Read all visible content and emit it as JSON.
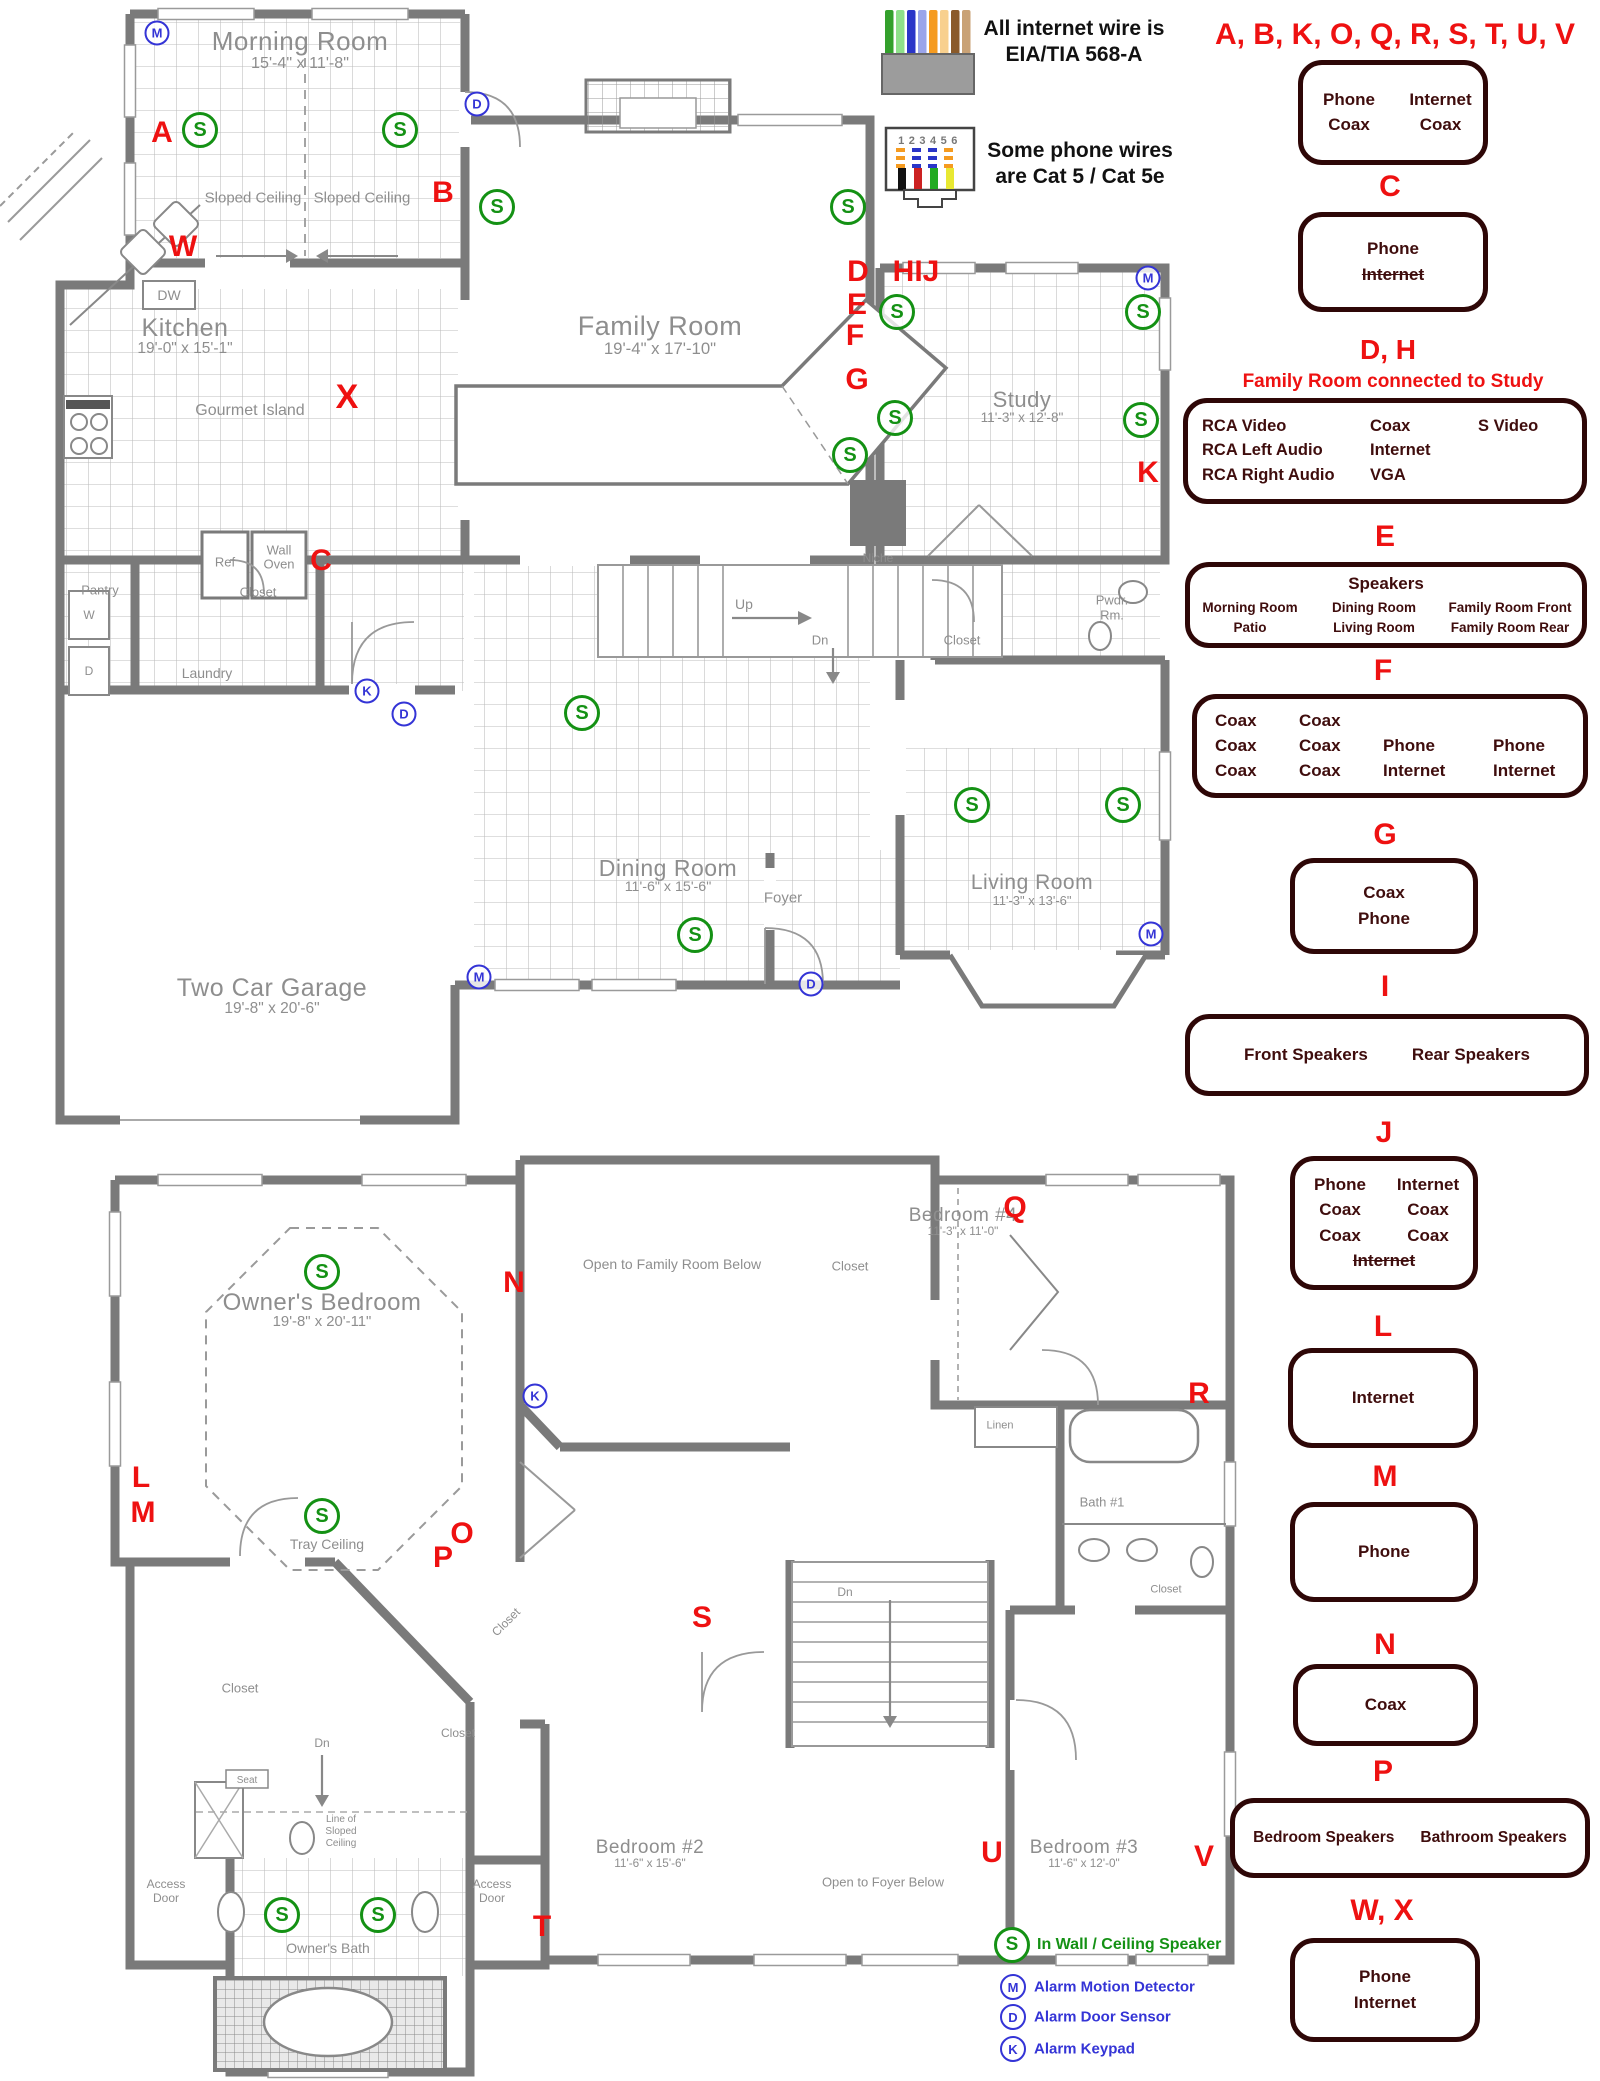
{
  "notes": {
    "internet_line1": "All internet wire is",
    "internet_line2": "EIA/TIA 568-A",
    "phone_line1": "Some phone wires",
    "phone_line2": "are Cat 5 / Cat 5e",
    "connector_numbers": "123456"
  },
  "colors": {
    "red": "#ee1111",
    "green": "#149114",
    "blue": "#3434d6",
    "box_border": "#2e0707",
    "box_text": "#3f0d0d",
    "wall": "#7a7a7a",
    "plan_text": "#8e8e8e"
  },
  "legend_sections": [
    {
      "id": "ABKOQRSTUV",
      "letters": "A, B, K, O, Q, R, S, T, U, V",
      "lx": 1395,
      "ly": 20,
      "lfs": 30,
      "box": [
        1298,
        60,
        190,
        105
      ],
      "cols": [
        95,
        88
      ],
      "rows": [
        [
          "Phone",
          "Internet"
        ],
        [
          "Coax",
          "Coax"
        ]
      ]
    },
    {
      "id": "C",
      "letters": "C",
      "lx": 1390,
      "ly": 172,
      "box": [
        1298,
        212,
        190,
        100
      ],
      "rows": [
        [
          "Phone"
        ],
        [
          "~Internet~"
        ]
      ]
    },
    {
      "id": "DH",
      "letters": "D, H",
      "lx": 1388,
      "ly": 336,
      "lfs": 28,
      "subtitle": "Family Room connected to Study",
      "sx": 1393,
      "sy": 372,
      "box": [
        1183,
        398,
        404,
        106
      ],
      "cols": [
        168,
        108,
        90
      ],
      "colAlign": "left",
      "padLeft": 14,
      "fs": 16.5,
      "rows": [
        [
          "RCA Video",
          "Coax",
          "S Video"
        ],
        [
          "RCA Left Audio",
          "Internet",
          ""
        ],
        [
          "RCA Right Audio",
          "VGA",
          ""
        ]
      ]
    },
    {
      "id": "E",
      "letters": "E",
      "lx": 1385,
      "ly": 522,
      "box": [
        1185,
        562,
        402,
        86
      ],
      "title": "Speakers",
      "cols": [
        130,
        118,
        154
      ],
      "fs": 13.5,
      "rows": [
        [
          "Morning Room",
          "Dining Room",
          "Family Room Front"
        ],
        [
          "Patio",
          "Living Room",
          "Family Room Rear"
        ]
      ]
    },
    {
      "id": "F",
      "letters": "F",
      "lx": 1383,
      "ly": 656,
      "box": [
        1192,
        694,
        396,
        104
      ],
      "cols": [
        84,
        84,
        110,
        110
      ],
      "colAlign": "left",
      "padLeft": 18,
      "rows": [
        [
          "Coax",
          "Coax",
          "",
          ""
        ],
        [
          "Coax",
          "Coax",
          "Phone",
          "Phone"
        ],
        [
          "Coax",
          "Coax",
          "Internet",
          "Internet"
        ]
      ]
    },
    {
      "id": "G",
      "letters": "G",
      "lx": 1385,
      "ly": 820,
      "box": [
        1290,
        858,
        188,
        96
      ],
      "rows": [
        [
          "Coax"
        ],
        [
          "Phone"
        ]
      ]
    },
    {
      "id": "I",
      "letters": "I",
      "lx": 1385,
      "ly": 972,
      "box": [
        1185,
        1014,
        404,
        82
      ],
      "gap": 44,
      "rows": [
        [
          "Front Speakers",
          "Rear Speakers"
        ]
      ]
    },
    {
      "id": "J",
      "letters": "J",
      "lx": 1384,
      "ly": 1118,
      "box": [
        1290,
        1156,
        188,
        134
      ],
      "cols": [
        88,
        88
      ],
      "rows": [
        [
          "Phone",
          "Internet"
        ],
        [
          "Coax",
          "Coax"
        ],
        [
          "Coax",
          "Coax"
        ],
        [
          "~Internet~"
        ]
      ]
    },
    {
      "id": "L",
      "letters": "L",
      "lx": 1383,
      "ly": 1312,
      "box": [
        1288,
        1348,
        190,
        100
      ],
      "rows": [
        [
          "Internet"
        ]
      ]
    },
    {
      "id": "M",
      "letters": "M",
      "lx": 1385,
      "ly": 1462,
      "box": [
        1290,
        1502,
        188,
        100
      ],
      "rows": [
        [
          "Phone"
        ]
      ]
    },
    {
      "id": "N",
      "letters": "N",
      "lx": 1385,
      "ly": 1630,
      "box": [
        1293,
        1664,
        185,
        82
      ],
      "rows": [
        [
          "Coax"
        ]
      ]
    },
    {
      "id": "P",
      "letters": "P",
      "lx": 1383,
      "ly": 1757,
      "box": [
        1230,
        1798,
        360,
        80
      ],
      "gap": 26,
      "fs": 15.5,
      "rows": [
        [
          "Bedroom Speakers",
          "Bathroom Speakers"
        ]
      ]
    },
    {
      "id": "WX",
      "letters": "W, X",
      "lx": 1382,
      "ly": 1896,
      "box": [
        1290,
        1938,
        190,
        104
      ],
      "rows": [
        [
          "Phone"
        ],
        [
          "Internet"
        ]
      ]
    }
  ],
  "symbol_legend": [
    {
      "symbol": "S",
      "label": "In Wall / Ceiling Speaker",
      "color": "#149114",
      "x": 1012,
      "y": 1945,
      "r": 15,
      "border": 3.5,
      "sfs": 19,
      "fs": 16
    },
    {
      "symbol": "M",
      "label": "Alarm Motion Detector",
      "color": "#3434d6",
      "x": 1013,
      "y": 1987,
      "r": 11,
      "border": 2.5,
      "sfs": 13,
      "fs": 15
    },
    {
      "symbol": "D",
      "label": "Alarm Door Sensor",
      "color": "#3434d6",
      "x": 1013,
      "y": 2017,
      "r": 11,
      "border": 2.5,
      "sfs": 13,
      "fs": 15
    },
    {
      "symbol": "K",
      "label": "Alarm Keypad",
      "color": "#3434d6",
      "x": 1013,
      "y": 2049,
      "r": 11,
      "border": 2.5,
      "sfs": 13,
      "fs": 15
    }
  ],
  "floor1": {
    "rooms": [
      {
        "name": "Morning Room",
        "dims": "15'-4\" x 11'-8\"",
        "x": 300,
        "y": 28,
        "fs": 26
      },
      {
        "name": "Kitchen",
        "dims": "19'-0\" x 15'-1\"",
        "x": 185,
        "y": 315,
        "fs": 25
      },
      {
        "name": "Family Room",
        "dims": "19'-4\" x 17'-10\"",
        "x": 660,
        "y": 312,
        "fs": 27
      },
      {
        "name": "Study",
        "dims": "11'-3\" x 12'-8\"",
        "x": 1022,
        "y": 388,
        "fs": 22
      },
      {
        "name": "Dining Room",
        "dims": "11'-6\" x 15'-6\"",
        "x": 668,
        "y": 856,
        "fs": 23
      },
      {
        "name": "Living Room",
        "dims": "11'-3\" x 13'-6\"",
        "x": 1032,
        "y": 872,
        "fs": 21
      },
      {
        "name": "Two Car Garage",
        "dims": "19'-8\" x 20'-6\"",
        "x": 272,
        "y": 975,
        "fs": 25
      }
    ],
    "labels": [
      {
        "t": "Sloped Ceiling",
        "x": 253,
        "y": 198,
        "fs": 15
      },
      {
        "t": "Sloped Ceiling",
        "x": 362,
        "y": 198,
        "fs": 15
      },
      {
        "t": "DW",
        "x": 169,
        "y": 295,
        "fs": 14
      },
      {
        "t": "Gourmet Island",
        "x": 250,
        "y": 411,
        "fs": 16
      },
      {
        "t": "Ref",
        "x": 225,
        "y": 562,
        "fs": 13
      },
      {
        "t": "Wall",
        "x": 279,
        "y": 550,
        "fs": 13
      },
      {
        "t": "Oven",
        "x": 279,
        "y": 564,
        "fs": 13
      },
      {
        "t": "Pantry",
        "x": 100,
        "y": 590,
        "fs": 13
      },
      {
        "t": "W",
        "x": 89,
        "y": 615,
        "fs": 12
      },
      {
        "t": "D",
        "x": 89,
        "y": 671,
        "fs": 12
      },
      {
        "t": "Laundry",
        "x": 207,
        "y": 673,
        "fs": 14
      },
      {
        "t": "Closet",
        "x": 258,
        "y": 592,
        "fs": 13
      },
      {
        "t": "Up",
        "x": 744,
        "y": 604,
        "fs": 14
      },
      {
        "t": "Dn",
        "x": 820,
        "y": 640,
        "fs": 13
      },
      {
        "t": "Niche",
        "x": 878,
        "y": 558,
        "fs": 12
      },
      {
        "t": "Closet",
        "x": 962,
        "y": 640,
        "fs": 13
      },
      {
        "t": "Pwdr.",
        "x": 1112,
        "y": 600,
        "fs": 13
      },
      {
        "t": "Rm.",
        "x": 1112,
        "y": 615,
        "fs": 13
      },
      {
        "t": "Foyer",
        "x": 783,
        "y": 898,
        "fs": 15
      }
    ],
    "letters": [
      {
        "t": "A",
        "x": 162,
        "y": 133
      },
      {
        "t": "B",
        "x": 443,
        "y": 193
      },
      {
        "t": "W",
        "x": 183,
        "y": 247
      },
      {
        "t": "X",
        "x": 347,
        "y": 397,
        "fs": 34
      },
      {
        "t": "C",
        "x": 321,
        "y": 561
      },
      {
        "t": "D",
        "x": 858,
        "y": 272
      },
      {
        "t": "HIJ",
        "x": 916,
        "y": 272
      },
      {
        "t": "E",
        "x": 857,
        "y": 305
      },
      {
        "t": "F",
        "x": 855,
        "y": 336
      },
      {
        "t": "G",
        "x": 857,
        "y": 380
      },
      {
        "t": "K",
        "x": 1148,
        "y": 473
      }
    ],
    "speakers": [
      [
        200,
        130
      ],
      [
        400,
        130
      ],
      [
        497,
        207
      ],
      [
        848,
        207
      ],
      [
        897,
        312
      ],
      [
        895,
        418
      ],
      [
        850,
        455
      ],
      [
        582,
        713
      ],
      [
        695,
        935
      ],
      [
        972,
        805
      ],
      [
        1123,
        805
      ],
      [
        1143,
        312
      ],
      [
        1141,
        420
      ]
    ],
    "alarms": [
      {
        "t": "M",
        "x": 157,
        "y": 33
      },
      {
        "t": "D",
        "x": 477,
        "y": 104
      },
      {
        "t": "M",
        "x": 1148,
        "y": 278
      },
      {
        "t": "K",
        "x": 367,
        "y": 691
      },
      {
        "t": "D",
        "x": 404,
        "y": 714
      },
      {
        "t": "M",
        "x": 479,
        "y": 977
      },
      {
        "t": "D",
        "x": 811,
        "y": 984
      },
      {
        "t": "M",
        "x": 1151,
        "y": 934
      }
    ]
  },
  "floor2": {
    "rooms": [
      {
        "name": "Owner's Bedroom",
        "dims": "19'-8\" x 20'-11\"",
        "x": 322,
        "y": 1290,
        "fs": 24
      },
      {
        "name": "Bedroom #4",
        "dims": "11'-3\" x 11'-0\"",
        "x": 963,
        "y": 1206,
        "fs": 19
      },
      {
        "name": "Bedroom #2",
        "dims": "11'-6\" x 15'-6\"",
        "x": 650,
        "y": 1838,
        "fs": 19
      },
      {
        "name": "Bedroom #3",
        "dims": "11'-6\" x 12'-0\"",
        "x": 1084,
        "y": 1838,
        "fs": 19
      }
    ],
    "labels": [
      {
        "t": "Open to Family Room Below",
        "x": 672,
        "y": 1264,
        "fs": 14
      },
      {
        "t": "Tray Ceiling",
        "x": 327,
        "y": 1544,
        "fs": 14
      },
      {
        "t": "Closet",
        "x": 850,
        "y": 1266,
        "fs": 13
      },
      {
        "t": "Linen",
        "x": 1000,
        "y": 1426,
        "fs": 11
      },
      {
        "t": "Bath #1",
        "x": 1102,
        "y": 1502,
        "fs": 13
      },
      {
        "t": "Closet",
        "x": 1166,
        "y": 1590,
        "fs": 11
      },
      {
        "t": "Closet",
        "x": 240,
        "y": 1688,
        "fs": 13
      },
      {
        "t": "Closet",
        "x": 506,
        "y": 1622,
        "fs": 12,
        "rot": -45
      },
      {
        "t": "Closet",
        "x": 458,
        "y": 1733,
        "fs": 12
      },
      {
        "t": "Dn",
        "x": 322,
        "y": 1743,
        "fs": 12
      },
      {
        "t": "Dn",
        "x": 845,
        "y": 1592,
        "fs": 12
      },
      {
        "t": "Seat",
        "x": 247,
        "y": 1781,
        "fs": 10
      },
      {
        "t": "Line of",
        "x": 341,
        "y": 1820,
        "fs": 10
      },
      {
        "t": "Sloped",
        "x": 341,
        "y": 1832,
        "fs": 10
      },
      {
        "t": "Ceiling",
        "x": 341,
        "y": 1844,
        "fs": 10
      },
      {
        "t": "Open to Foyer Below",
        "x": 883,
        "y": 1882,
        "fs": 13
      },
      {
        "t": "Owner's Bath",
        "x": 328,
        "y": 1948,
        "fs": 14
      },
      {
        "t": "Access",
        "x": 166,
        "y": 1884,
        "fs": 12
      },
      {
        "t": "Door",
        "x": 166,
        "y": 1898,
        "fs": 12
      },
      {
        "t": "Access",
        "x": 492,
        "y": 1884,
        "fs": 12
      },
      {
        "t": "Door",
        "x": 492,
        "y": 1898,
        "fs": 12
      }
    ],
    "letters": [
      {
        "t": "N",
        "x": 514,
        "y": 1283
      },
      {
        "t": "Q",
        "x": 1015,
        "y": 1208
      },
      {
        "t": "R",
        "x": 1199,
        "y": 1394
      },
      {
        "t": "L",
        "x": 141,
        "y": 1478
      },
      {
        "t": "M",
        "x": 143,
        "y": 1513
      },
      {
        "t": "O",
        "x": 462,
        "y": 1534
      },
      {
        "t": "P",
        "x": 443,
        "y": 1558
      },
      {
        "t": "S",
        "x": 702,
        "y": 1618
      },
      {
        "t": "T",
        "x": 542,
        "y": 1927
      },
      {
        "t": "U",
        "x": 992,
        "y": 1853
      },
      {
        "t": "V",
        "x": 1204,
        "y": 1857
      }
    ],
    "speakers": [
      [
        322,
        1272
      ],
      [
        322,
        1516
      ],
      [
        282,
        1915
      ],
      [
        378,
        1915
      ]
    ],
    "alarms": [
      {
        "t": "K",
        "x": 535,
        "y": 1396
      }
    ]
  }
}
